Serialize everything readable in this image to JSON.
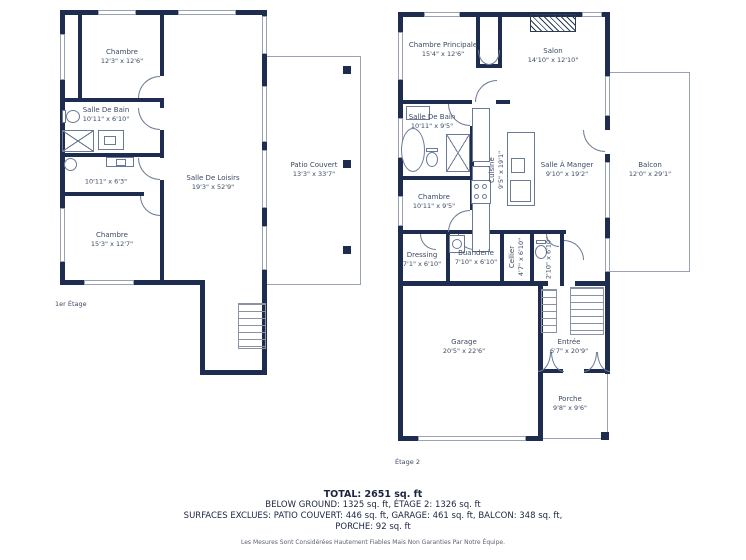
{
  "colors": {
    "wall": "#1e2c4f",
    "thin_line": "#9aa2b1",
    "label_text": "#3c4a63",
    "summary_text": "#1c2540"
  },
  "floor1": {
    "label": "1er Étage",
    "rooms": {
      "chambre1": {
        "name": "Chambre",
        "dims": "12'3\" x 12'6\""
      },
      "salle_de_bain": {
        "name": "Salle De Bain",
        "dims": "10'11\" x 6'10\""
      },
      "salle_eau": {
        "name": "",
        "dims": "10'11\" x 6'3\""
      },
      "chambre2": {
        "name": "Chambre",
        "dims": "15'3\" x 12'7\""
      },
      "salle_de_loisirs": {
        "name": "Salle De Loisirs",
        "dims": "19'3\" x 52'9\""
      },
      "patio_couvert": {
        "name": "Patio Couvert",
        "dims": "13'3\" x 33'7\""
      }
    }
  },
  "floor2": {
    "label": "Étage 2",
    "rooms": {
      "chambre_principale": {
        "name": "Chambre Principale",
        "dims": "15'4\" x 12'6\""
      },
      "salon": {
        "name": "Salon",
        "dims": "14'10\" x 12'10\""
      },
      "salle_de_bain": {
        "name": "Salle De Bain",
        "dims": "10'11\" x 9'5\""
      },
      "cuisine": {
        "name": "Cuisine",
        "dims": "9'5\" x 19'1\""
      },
      "salle_a_manger": {
        "name": "Salle À Manger",
        "dims": "9'10\" x 19'2\""
      },
      "chambre": {
        "name": "Chambre",
        "dims": "10'11\" x 9'5\""
      },
      "dressing": {
        "name": "Dressing",
        "dims": "7'1\" x 6'10\""
      },
      "buanderie": {
        "name": "Buanderie",
        "dims": "7'10\" x 6'10\""
      },
      "cellier": {
        "name": "Cellier",
        "dims": "4'7\" x 6'10\""
      },
      "wc": {
        "name": "",
        "dims": "2'10\" x 6'10\""
      },
      "balcon": {
        "name": "Balcon",
        "dims": "12'0\" x 29'1\""
      },
      "garage": {
        "name": "Garage",
        "dims": "20'5\" x 22'6\""
      },
      "entree": {
        "name": "Entrée",
        "dims": "6'7\" x 20'9\""
      },
      "porche": {
        "name": "Porche",
        "dims": "9'8\" x 9'6\""
      }
    }
  },
  "summary": {
    "total": "TOTAL: 2651 sq. ft",
    "line1": "BELOW GROUND: 1325 sq. ft, ÉTAGE 2: 1326 sq. ft",
    "line2": "SURFACES EXCLUES: PATIO COUVERT: 446 sq. ft, GARAGE: 461 sq. ft, BALCON: 348 sq. ft,",
    "line3": "PORCHE: 92 sq. ft",
    "disclaimer": "Les Mesures Sont Considérées Hautement Fiables Mais Non Garanties Par Notre Équipe."
  }
}
